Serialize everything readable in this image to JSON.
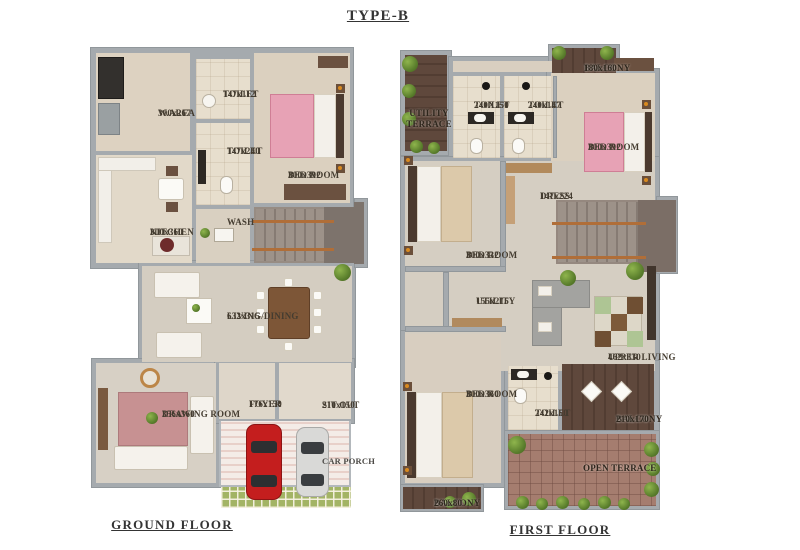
{
  "title": "TYPE-B",
  "ground_floor": {
    "label": "GROUND FLOOR",
    "rooms": {
      "warea": {
        "name": "W.AREA",
        "dims": "300x267"
      },
      "toilet1": {
        "name": "TOILET",
        "dims": "147x112"
      },
      "toilet2": {
        "name": "TOILET",
        "dims": "147x240"
      },
      "bedroom": {
        "name": "BED ROOM",
        "dims": "300x392"
      },
      "kitchen": {
        "name": "KITCHEN",
        "dims": "300x360"
      },
      "wash": {
        "name": "WASH",
        "dims": ""
      },
      "living_dining": {
        "name": "LIVING/DINING",
        "dims": "632x315"
      },
      "drawing_room": {
        "name": "DRAWING ROOM",
        "dims": "356x360"
      },
      "foyer": {
        "name": "FOYER",
        "dims": "176x150"
      },
      "sit_out": {
        "name": "SIT OUT",
        "dims": "210x150"
      },
      "car_porch": {
        "name": "CAR PORCH",
        "dims": ""
      }
    }
  },
  "first_floor": {
    "label": "FIRST FLOOR",
    "rooms": {
      "utility_terrace": {
        "name": "UTILITY TERRACE",
        "dims": ""
      },
      "toilet1": {
        "name": "TOILET",
        "dims": "240X150"
      },
      "toilet2": {
        "name": "TOILET",
        "dims": "240x147"
      },
      "balcony_top": {
        "name": "BALCONY",
        "dims": "180x160"
      },
      "bedroom_top": {
        "name": "BED ROOM",
        "dims": "300x392"
      },
      "dress": {
        "name": "DRESS",
        "dims": "147x224"
      },
      "bedroom_mid": {
        "name": "BED ROOM",
        "dims": "300x332"
      },
      "utility": {
        "name": "UTILITY",
        "dims": "155x215"
      },
      "upper_living": {
        "name": "UPPER LIVING",
        "dims": "462x330"
      },
      "bedroom_bottom": {
        "name": "BED ROOM",
        "dims": "300x360"
      },
      "toilet3": {
        "name": "TOILET",
        "dims": "242x150"
      },
      "balcony_mid": {
        "name": "BALCONY",
        "dims": "210x170"
      },
      "open_terrace": {
        "name": "OPEN TERRACE",
        "dims": ""
      },
      "balcony_bottom": {
        "name": "BALCONY",
        "dims": "260x80"
      }
    }
  },
  "colors": {
    "wall": "#a5aaae",
    "floor_cream": "#ddd3c3",
    "floor_tile": "#e7decd",
    "wood_dark": "#5e473b",
    "terrace_tile": "#a57d6f",
    "grass": "#a3b465",
    "bed_pink": "#e7a2b5",
    "stair_rail": "#b06e38",
    "label_text": "#443c30"
  }
}
